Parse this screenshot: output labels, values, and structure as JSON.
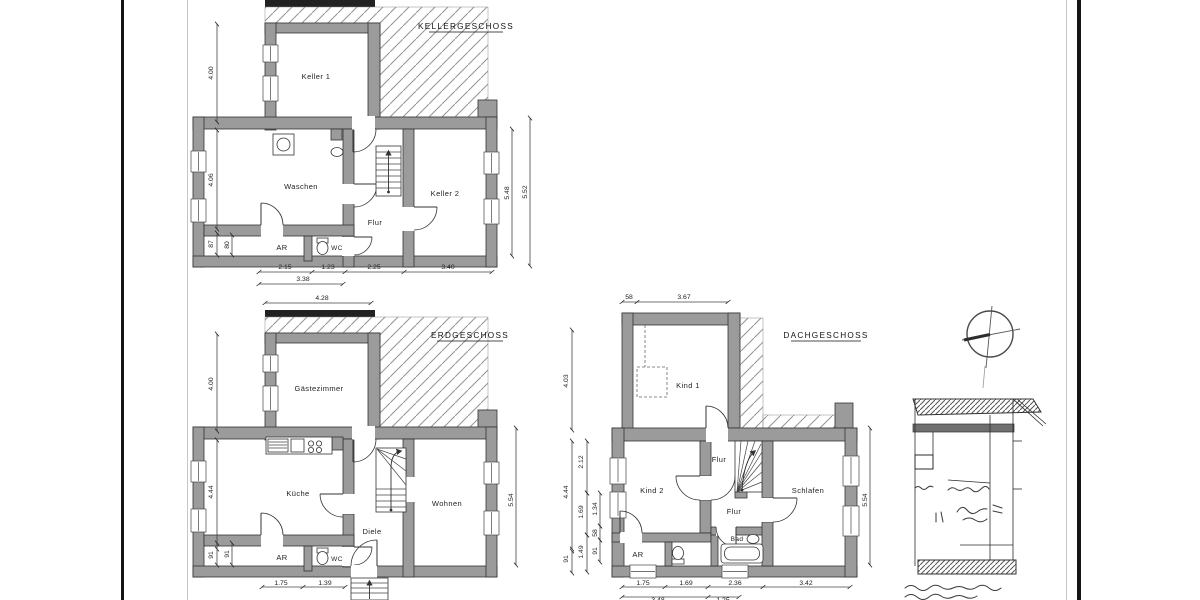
{
  "palette": {
    "ink": "#1f1f1f",
    "wall_fill": "#9b9b9b",
    "wall_stroke": "#333333",
    "hatch": "#999999",
    "frame": "#141414"
  },
  "floors": {
    "kg": {
      "title": "KELLERGESCHOSS",
      "rooms": {
        "keller1": "Keller 1",
        "waschen": "Waschen",
        "keller2": "Keller 2",
        "flur": "Flur",
        "ar": "AR",
        "wc": "WC"
      },
      "dims": {
        "left": [
          "4.00",
          "4.06",
          "87",
          "80"
        ],
        "right": [
          "5.48",
          "5.52"
        ],
        "bottom": [
          "2.15",
          "1.23",
          "2.25",
          "3.40"
        ],
        "bottom2": [
          "3.38"
        ]
      }
    },
    "eg": {
      "title": "ERDGESCHOSS",
      "rooms": {
        "gaestezimmer": "Gästezimmer",
        "kueche": "Küche",
        "wohnen": "Wohnen",
        "diele": "Diele",
        "ar": "AR",
        "wc": "WC"
      },
      "dims": {
        "top": [
          "4.28"
        ],
        "left": [
          "4.00",
          "4.44",
          "91",
          "91"
        ],
        "right": [
          "5.54"
        ],
        "bottom": [
          "1.75",
          "1.39"
        ]
      }
    },
    "dg": {
      "title": "DACHGESCHOSS",
      "rooms": {
        "kind1": "Kind 1",
        "kind2": "Kind 2",
        "flur1": "Flur",
        "flur2": "Flur",
        "schlafen": "Schlafen",
        "bad": "Bad",
        "ar": "AR"
      },
      "dims": {
        "top": [
          "58",
          "3.67"
        ],
        "left_outer": [
          "4.03",
          "4.44",
          "91"
        ],
        "left_mid": [
          "2.12",
          "1.69",
          "1.49"
        ],
        "left_inner": [
          "1.34",
          "58",
          "91"
        ],
        "right": [
          "5.54"
        ],
        "bottom": [
          "1.75",
          "1.69",
          "2.36",
          "3.42"
        ],
        "bottom2": [
          "3.48",
          "1.25"
        ]
      }
    }
  }
}
